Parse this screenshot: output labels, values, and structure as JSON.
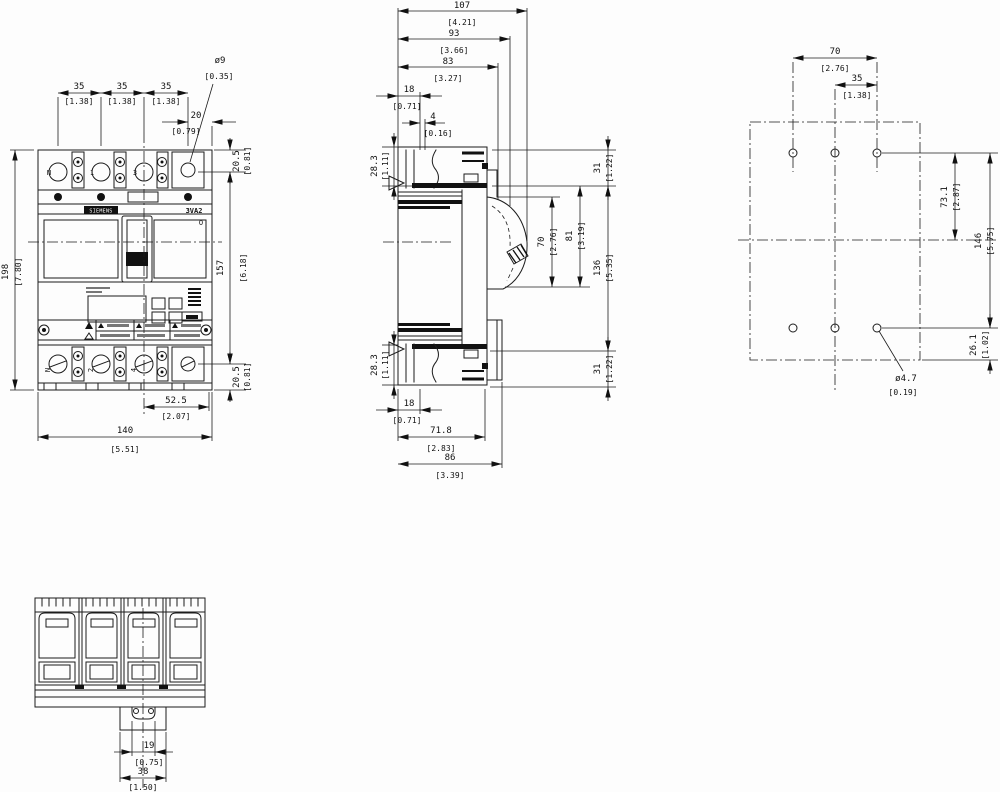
{
  "front": {
    "brand": "SIEMENS",
    "model": "3VA2",
    "off_symbol": "O",
    "terminals_top": [
      "N",
      "1",
      "3"
    ],
    "terminals_bottom": [
      "N",
      "2",
      "4"
    ],
    "dims": {
      "pitch1": {
        "mm": "35",
        "in": "[1.38]"
      },
      "pitch2": {
        "mm": "35",
        "in": "[1.38]"
      },
      "pitch3": {
        "mm": "35",
        "in": "[1.38]"
      },
      "hole_offset": {
        "mm": "20",
        "in": "[0.79]"
      },
      "hole_dia": {
        "mm": "ø9",
        "in": "[0.35]"
      },
      "top_to_hole": {
        "mm": "20.5",
        "in": "[0.81]"
      },
      "hole_span": {
        "mm": "157",
        "in": "[6.18]"
      },
      "hole_to_bottom": {
        "mm": "20.5",
        "in": "[0.81]"
      },
      "height": {
        "mm": "198",
        "in": "[7.80]"
      },
      "foot": {
        "mm": "52.5",
        "in": "[2.07]"
      },
      "width": {
        "mm": "140",
        "in": "[5.51]"
      }
    }
  },
  "side": {
    "dims": {
      "total_depth": {
        "mm": "107",
        "in": "[4.21]"
      },
      "depth_93": {
        "mm": "93",
        "in": "[3.66]"
      },
      "depth_83": {
        "mm": "83",
        "in": "[3.27]"
      },
      "front_18_top": {
        "mm": "18",
        "in": "[0.71]"
      },
      "step_4": {
        "mm": "4",
        "in": "[0.16]"
      },
      "term_283_top": {
        "mm": "28.3",
        "in": "[1.11]"
      },
      "term_283_bottom": {
        "mm": "28.3",
        "in": "[1.11]"
      },
      "front_18_bottom": {
        "mm": "18",
        "in": "[0.71]"
      },
      "base_718": {
        "mm": "71.8",
        "in": "[2.83]"
      },
      "base_86": {
        "mm": "86",
        "in": "[3.39]"
      },
      "edge_31_top": {
        "mm": "31",
        "in": "[1.22]"
      },
      "handle_70": {
        "mm": "70",
        "in": "[2.76]"
      },
      "handle_81": {
        "mm": "81",
        "in": "[3.19]"
      },
      "mid_136": {
        "mm": "136",
        "in": "[5.35]"
      },
      "edge_31_bottom": {
        "mm": "31",
        "in": "[1.22]"
      }
    }
  },
  "drill": {
    "dims": {
      "span_70": {
        "mm": "70",
        "in": "[2.76]"
      },
      "span_35": {
        "mm": "35",
        "in": "[1.38]"
      },
      "v_731": {
        "mm": "73.1",
        "in": "[2.87]"
      },
      "v_146": {
        "mm": "146",
        "in": "[5.75]"
      },
      "v_261": {
        "mm": "26.1",
        "in": "[1.02]"
      },
      "hole_dia": {
        "mm": "ø4.7",
        "in": "[0.19]"
      }
    }
  },
  "bottom_view": {
    "dims": {
      "rail_tab": {
        "mm": "19",
        "in": "[0.75]"
      },
      "rail_width": {
        "mm": "38",
        "in": "[1.50]"
      }
    }
  }
}
